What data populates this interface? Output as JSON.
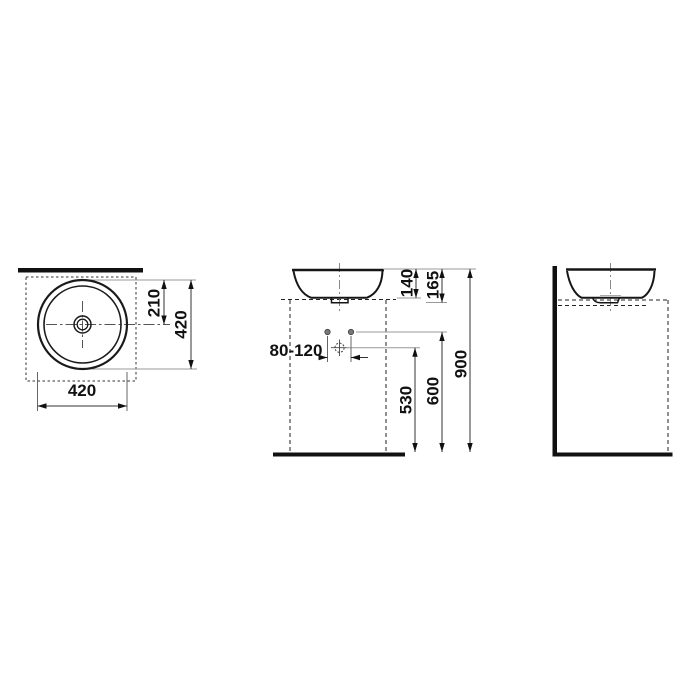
{
  "drawing": {
    "title": "countertop-washbasin-dimension-drawing",
    "line_color": "#1a1a1a",
    "dim_color": "#333333",
    "leader_color": "#999999",
    "background": "#ffffff"
  },
  "dims": {
    "top_view": {
      "center_offset": "210",
      "depth": "420",
      "width": "420"
    },
    "front_view": {
      "height_above_counter": "140",
      "total_basin_height": "165",
      "tap_hole_range": "80-120",
      "drain_height": "530",
      "fixing_holes_height": "600",
      "rim_height": "900"
    }
  }
}
